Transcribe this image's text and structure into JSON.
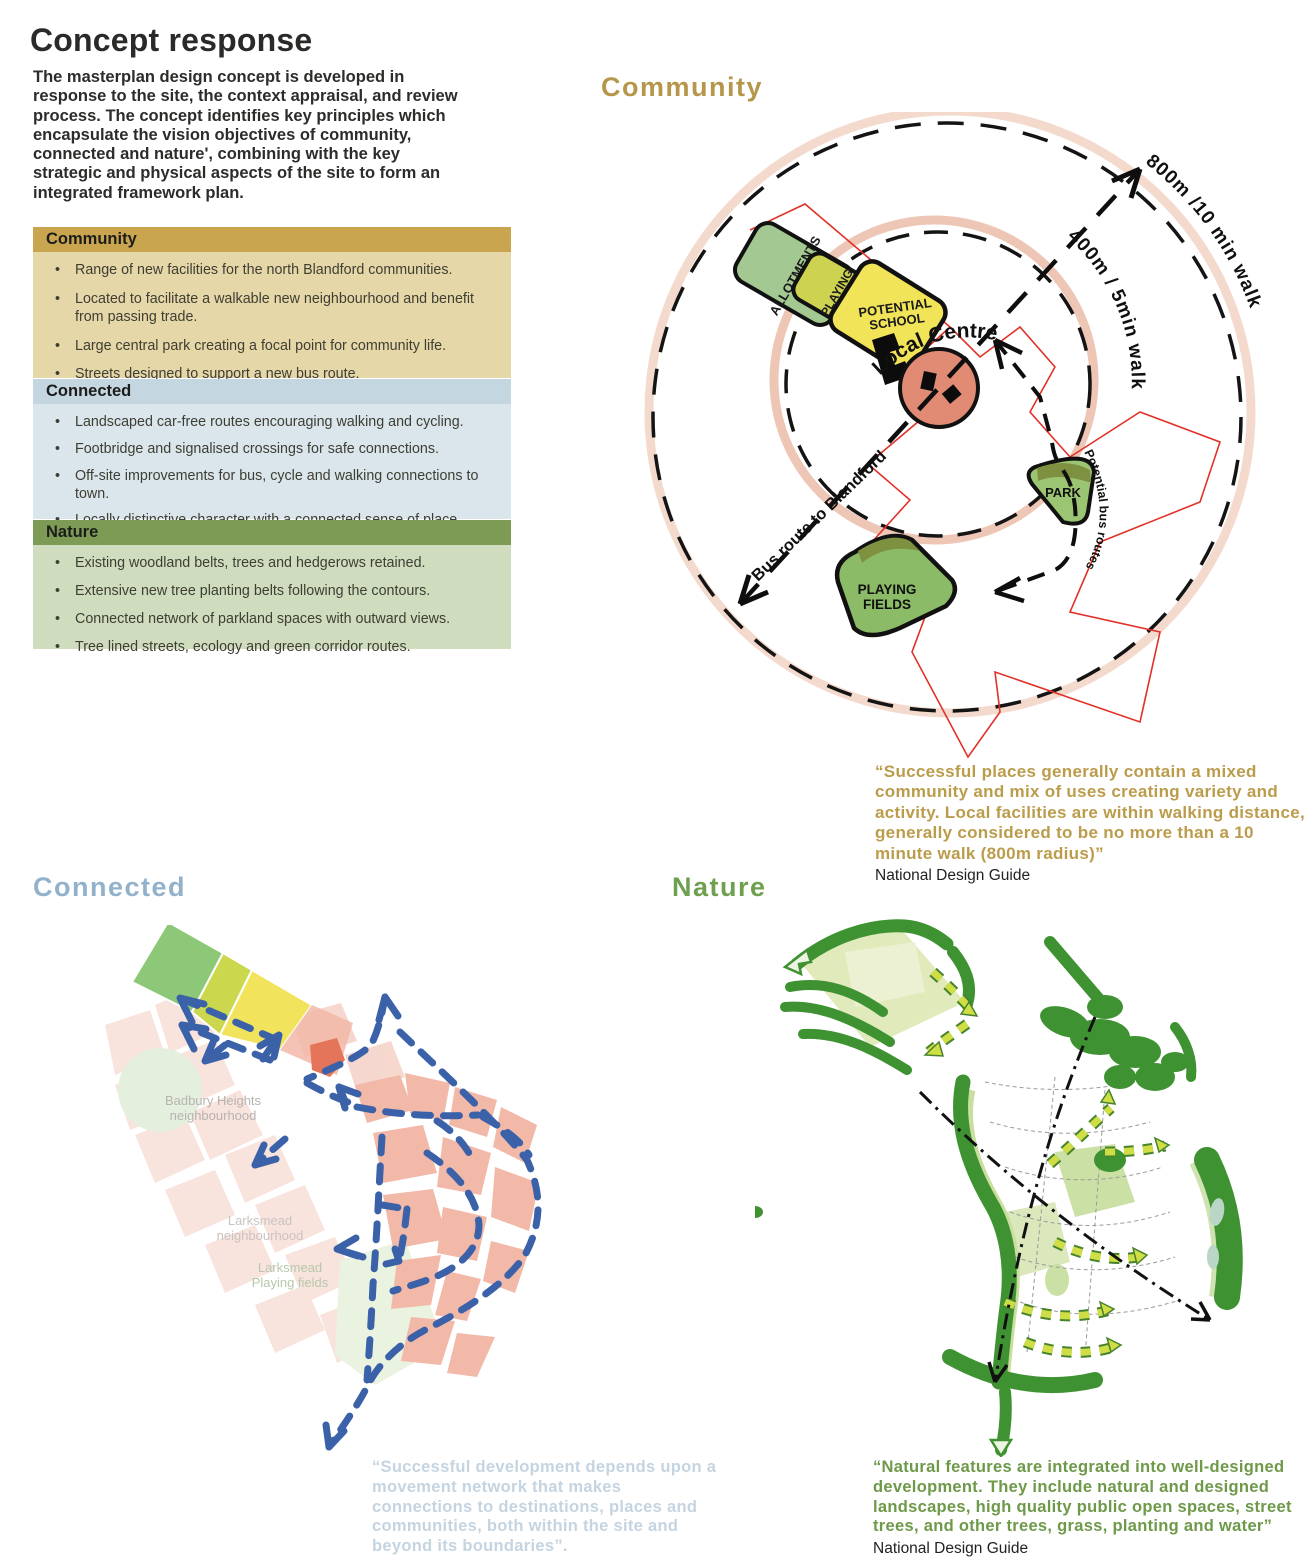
{
  "header": {
    "title": "Concept response",
    "intro": "The masterplan design concept  is developed in response to the site, the context appraisal, and review process. The concept identifies key principles which encapsulate the vision objectives of community, connected and nature', combining with the key strategic and physical aspects of the site to form an integrated framework plan."
  },
  "panels": [
    {
      "title": "Community",
      "bullets": [
        "Range of new facilities for the  north Blandford communities.",
        "Located to facilitate a walkable new neighbourhood and benefit from passing trade.",
        "Large central park creating a focal point for community life.",
        "Streets designed to support a new bus route."
      ]
    },
    {
      "title": "Connected",
      "bullets": [
        "Landscaped car-free routes encouraging walking and cycling.",
        "Footbridge and signalised crossings for safe connections.",
        "Off-site improvements for bus, cycle and walking connections to town.",
        "Locally distinctive character with a connected sense of place."
      ]
    },
    {
      "title": "Nature",
      "bullets": [
        "Existing woodland belts, trees and hedgerows retained.",
        "Extensive new tree planting belts following the contours.",
        "Connected network of parkland spaces with outward views.",
        "Tree lined streets, ecology and green corridor routes."
      ]
    }
  ],
  "community_diagram": {
    "heading": "Community",
    "labels": {
      "allotments": "ALLOTMENTS",
      "playing_small_l1": "PLAYING",
      "playing_small_l2": "FIELDS",
      "school_l1": "POTENTIAL",
      "school_l2": "SCHOOL",
      "local_centre": "Local Centre",
      "park": "PARK",
      "playing_l1": "PLAYING",
      "playing_l2": "FIELDS",
      "radius_outer": "800m /10 min walk",
      "radius_inner": "400m / 5min walk",
      "bus_route": "Bus route to Blandford",
      "potential_bus_routes": "Potential bus routes"
    },
    "quote": "“Successful places generally contain a mixed community and mix of uses creating variety and activity. Local facilities are within walking distance, generally considered to be no more than a 10 minute walk (800m radius)”",
    "source": "National Design Guide"
  },
  "connected_diagram": {
    "heading": "Connected",
    "labels": {
      "badbury_l1": "Badbury Heights",
      "badbury_l2": "neighbourhood",
      "larksmead_l1": "Larksmead",
      "larksmead_l2": "neighbourhood",
      "larksmead_pf_l1": "Larksmead",
      "larksmead_pf_l2": "Playing fields"
    },
    "quote": "“Successful development depends upon a movement network that makes connections to destinations, places and communities, both within the site and beyond its boundaries”.",
    "source": "National Design Guide"
  },
  "nature_diagram": {
    "heading": "Nature",
    "quote": "“Natural features are integrated into well-designed development. They include natural and designed landscapes, high quality public open spaces, street trees, and other trees, grass, planting and water”",
    "source": "National Design Guide"
  },
  "colors": {
    "community_accent": "#b5964a",
    "community_header": "#c9a550",
    "community_body": "#e6d7a8",
    "connected_accent": "#92b2cc",
    "connected_header": "#c4d6e0",
    "connected_body": "#dae6ec",
    "nature_accent": "#6fa050",
    "nature_header": "#7d9b55",
    "nature_body": "#cfdcbe",
    "local_centre_salmon": "#e18a74",
    "walk_ring_pink": "#efcdbd",
    "site_boundary_red": "#e13128",
    "route_blue": "#3b62a8",
    "woodland_green": "#3e9231",
    "tree_belt_yellow_green": "#cede44",
    "school_yellow": "#f2e458",
    "allotments_green": "#a3c892",
    "parkland_green": "#8cbb67"
  }
}
